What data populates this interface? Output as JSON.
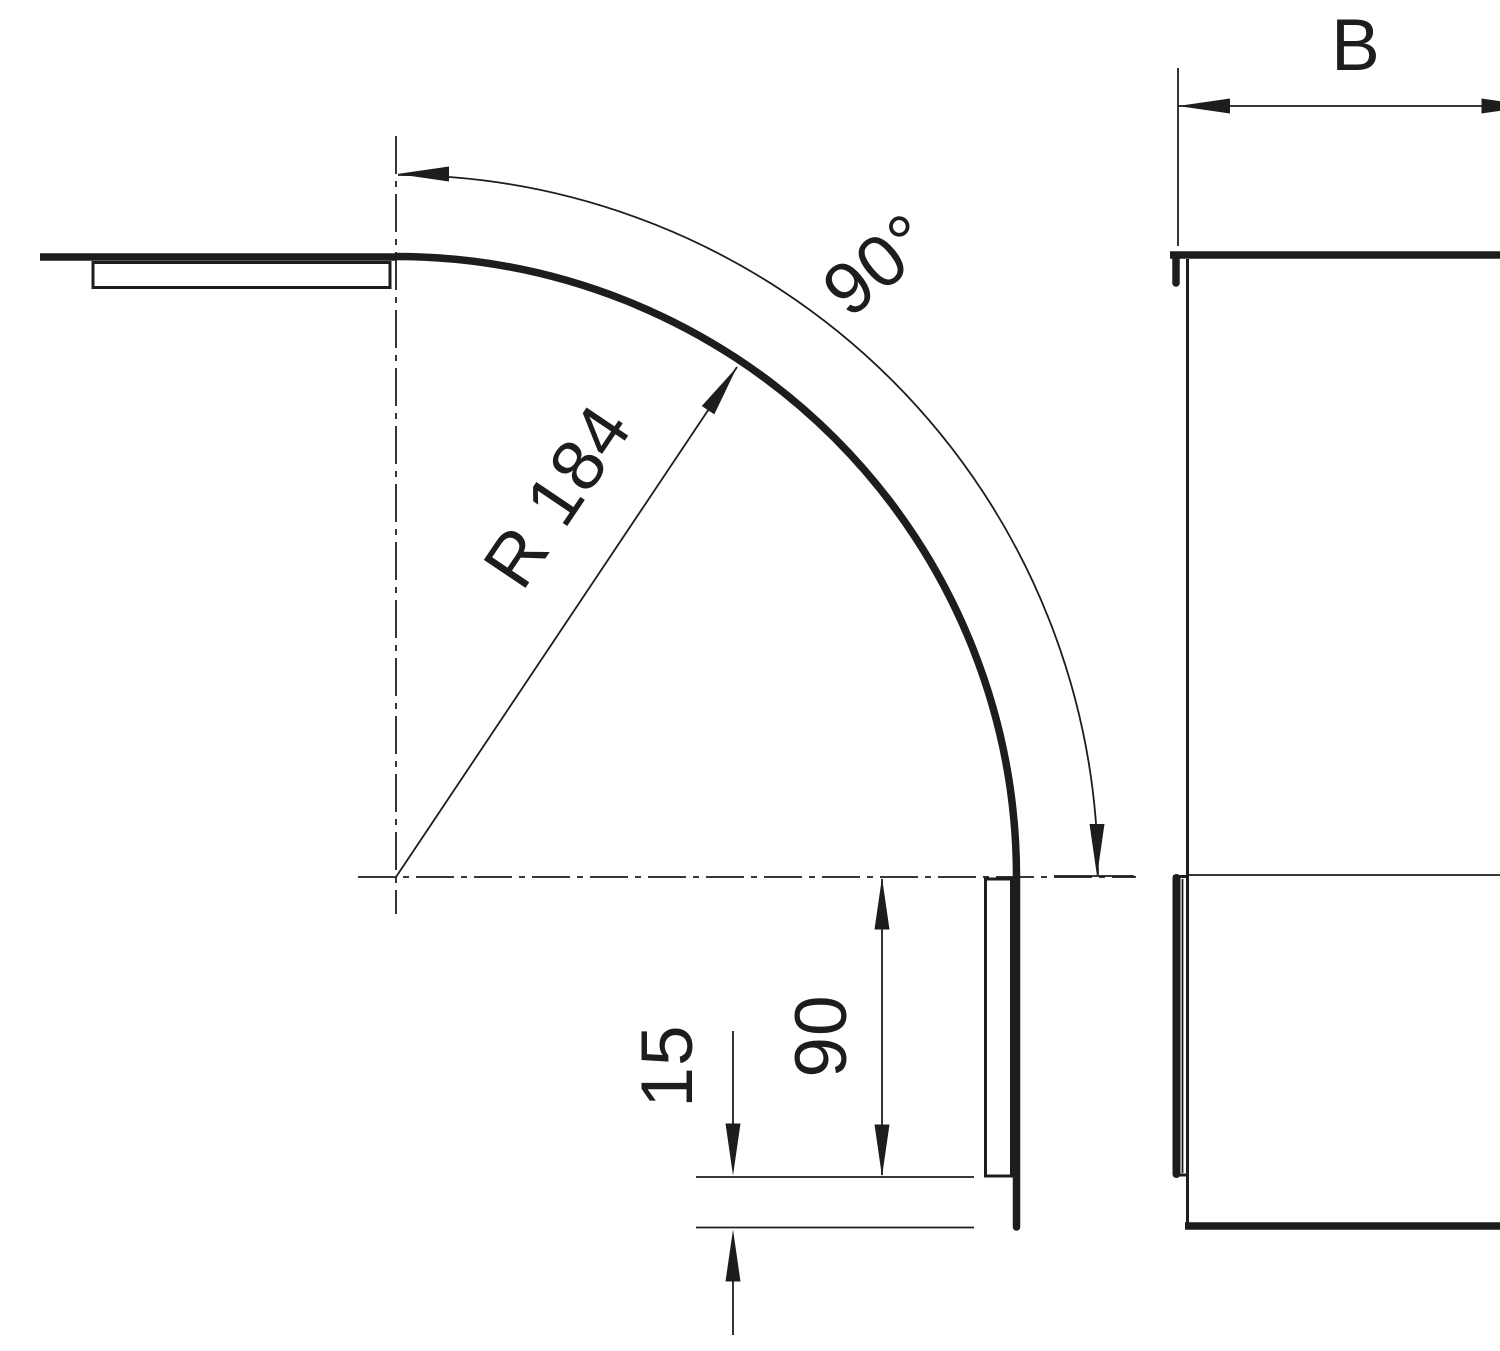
{
  "drawing": {
    "type": "technical-dimension-drawing",
    "description": "90 degree bend with cover: side elevation with bend radius and top view with width dimension",
    "colors": {
      "line": "#1d1d1b",
      "background": "#ffffff"
    },
    "dimensions": {
      "angle": {
        "label": "90°",
        "value": 90
      },
      "radius": {
        "label": "R 184",
        "value": 184
      },
      "length": {
        "label": "90",
        "value": 90
      },
      "overhang": {
        "label": "15",
        "value": 15
      },
      "width": {
        "label": "B"
      }
    }
  }
}
